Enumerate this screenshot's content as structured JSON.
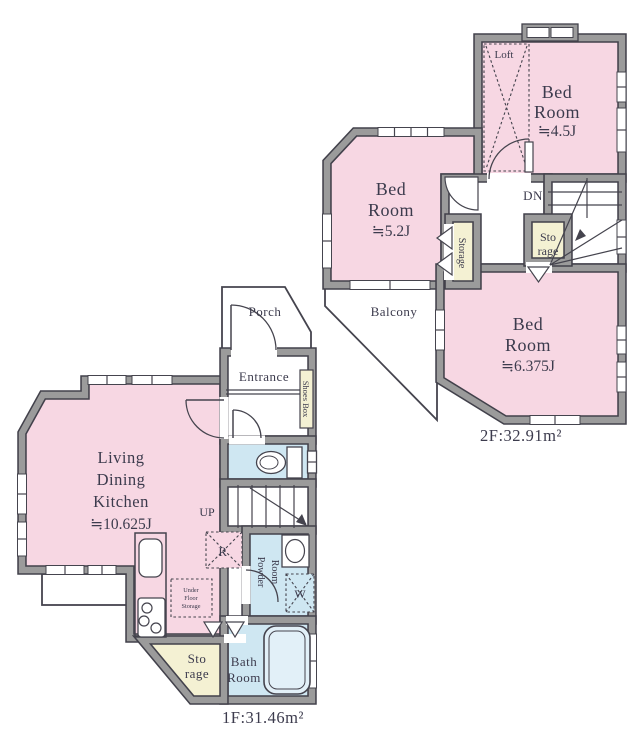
{
  "colors": {
    "room_pink": "#f7d7e3",
    "room_blue": "#cfe7f2",
    "closet_cream": "#f4f1d3",
    "wall_gray": "#9b9b9b",
    "wall_dark": "#42414b",
    "label_text": "#3c3b4d"
  },
  "floor2": {
    "area_label": "2F:32.91m²",
    "bedroom_45": {
      "l1": "Bed",
      "l2": "Room",
      "size": "≒4.5J"
    },
    "bedroom_52": {
      "l1": "Bed",
      "l2": "Room",
      "size": "≒5.2J"
    },
    "bedroom_6375": {
      "l1": "Bed",
      "l2": "Room",
      "size": "≒6.375J"
    },
    "loft": "Loft",
    "down": "DN",
    "balcony": "Balcony",
    "storage_side": "Storage",
    "storage_mid": {
      "l1": "Sto",
      "l2": "rage"
    }
  },
  "floor1": {
    "area_label": "1F:31.46m²",
    "ldk": {
      "l1": "Living",
      "l2": "Dining",
      "l3": "Kitchen",
      "size": "≒10.625J"
    },
    "porch": "Porch",
    "entrance": "Entrance",
    "shoes_box": "Shoes Box",
    "up": "UP",
    "refrigerator": "R",
    "under_floor": {
      "l1": "Under",
      "l2": "Floor",
      "l3": "Storage"
    },
    "powder": {
      "l1": "Powder",
      "l2": "Room"
    },
    "washer": "W",
    "bath": {
      "l1": "Bath",
      "l2": "Room"
    },
    "storage": {
      "l1": "Sto",
      "l2": "rage"
    }
  }
}
